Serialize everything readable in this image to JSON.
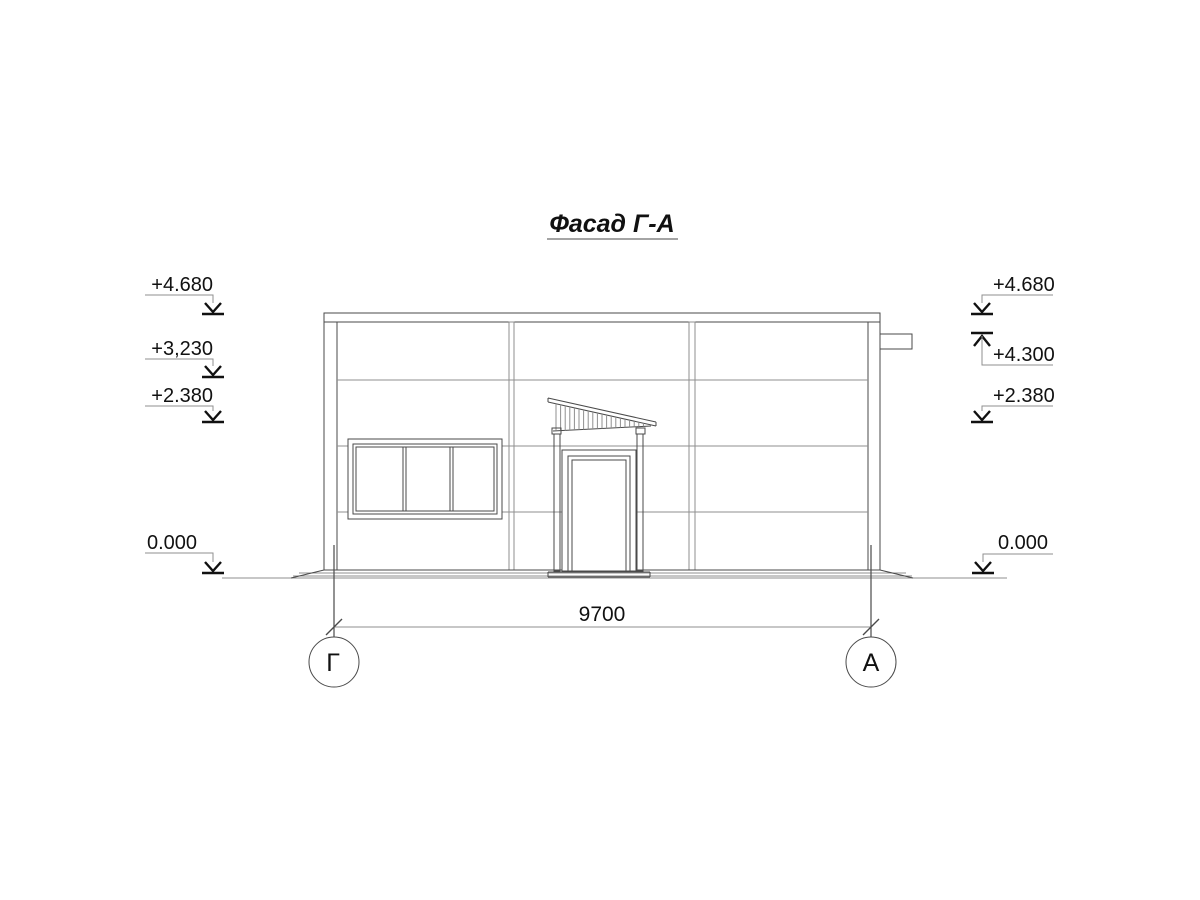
{
  "title": "Фасад Г-А",
  "elevation_marks": {
    "left": [
      {
        "label": "+4.680"
      },
      {
        "label": "+3,230"
      },
      {
        "label": "+2.380"
      },
      {
        "label": "0.000"
      }
    ],
    "right": [
      {
        "label": "+4.680"
      },
      {
        "label": "+4.300"
      },
      {
        "label": "+2.380"
      },
      {
        "label": "0.000"
      }
    ]
  },
  "dimension": {
    "value": "9700"
  },
  "grid_axes": {
    "left": "Г",
    "right": "А"
  },
  "colors": {
    "line": "#4a4a4a",
    "line_light": "#8f8f8f",
    "text": "#111111",
    "background": "#ffffff"
  }
}
